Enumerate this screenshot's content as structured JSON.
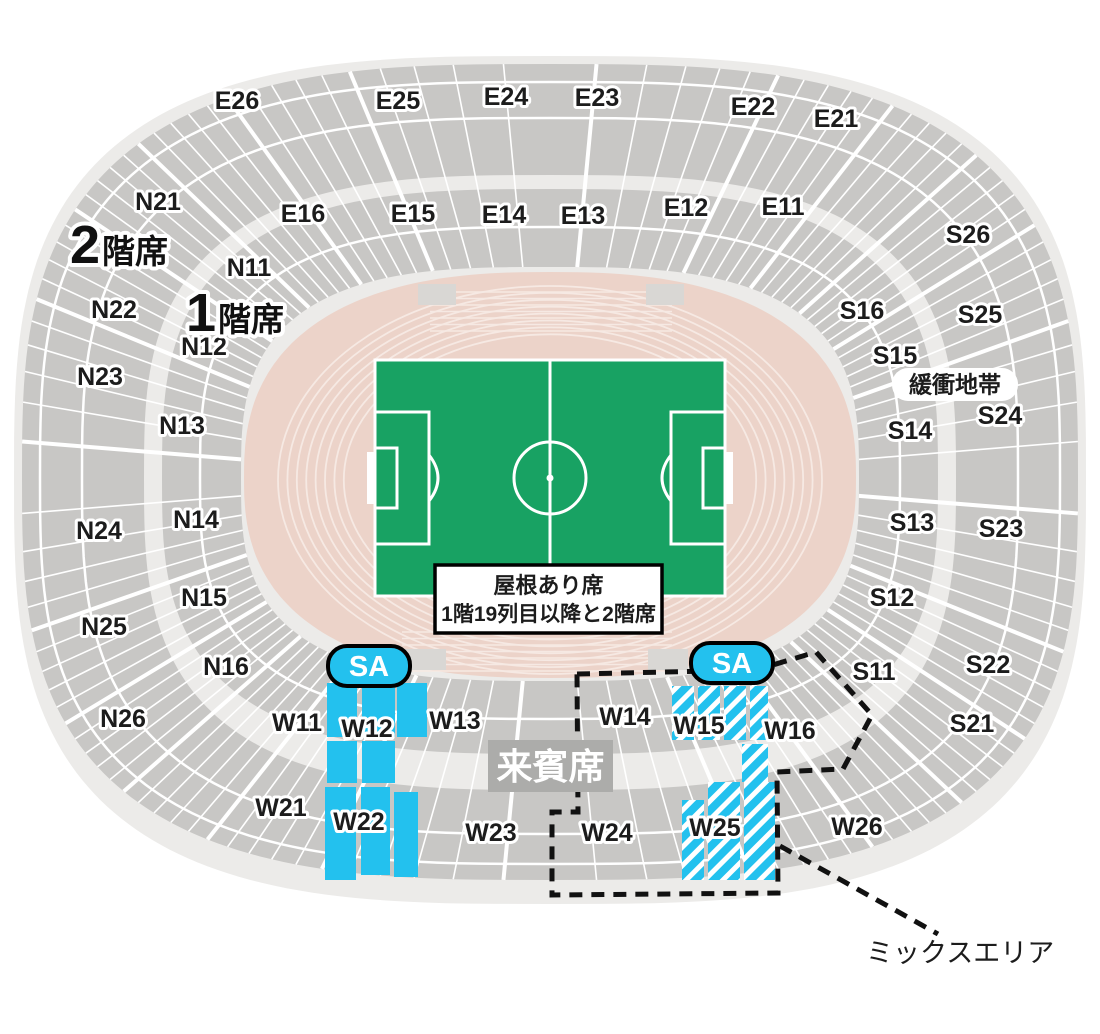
{
  "tier_labels": {
    "tier2": {
      "num": "2",
      "suffix": "階席",
      "x": 70,
      "y": 263
    },
    "tier1": {
      "num": "1",
      "suffix": "階席",
      "x": 186,
      "y": 331
    }
  },
  "info_box": {
    "line1": "屋根あり席",
    "line2": "1階19列目以降と2階席",
    "x": 435,
    "y": 565,
    "w": 227,
    "h": 68
  },
  "badges": {
    "sa_label": "SA",
    "sa_positions": [
      {
        "x": 369,
        "y": 666
      },
      {
        "x": 732,
        "y": 663
      }
    ],
    "vip": {
      "label": "来賓席",
      "x": 488,
      "y": 740,
      "w": 125,
      "h": 52
    },
    "buffer": {
      "label": "緩衝地帯",
      "x": 892,
      "y": 368,
      "w": 126,
      "h": 33
    }
  },
  "mix_area": {
    "label": "ミックスエリア",
    "label_x": 866,
    "label_y": 962,
    "outline_points": "577,674 756,670 816,652 872,715 843,769 777,772 778,893 552,895 552,812 578,812",
    "leader": {
      "x1": 780,
      "y1": 846,
      "x2": 938,
      "y2": 934
    }
  },
  "section_labels": [
    {
      "t": "E26",
      "x": 237,
      "y": 100
    },
    {
      "t": "E25",
      "x": 398,
      "y": 100
    },
    {
      "t": "E24",
      "x": 506,
      "y": 96
    },
    {
      "t": "E23",
      "x": 597,
      "y": 97
    },
    {
      "t": "E22",
      "x": 753,
      "y": 106
    },
    {
      "t": "E21",
      "x": 836,
      "y": 118
    },
    {
      "t": "E16",
      "x": 303,
      "y": 213
    },
    {
      "t": "E15",
      "x": 413,
      "y": 213
    },
    {
      "t": "E14",
      "x": 504,
      "y": 214
    },
    {
      "t": "E13",
      "x": 583,
      "y": 215
    },
    {
      "t": "E12",
      "x": 686,
      "y": 207
    },
    {
      "t": "E11",
      "x": 783,
      "y": 206
    },
    {
      "t": "N21",
      "x": 158,
      "y": 201
    },
    {
      "t": "N22",
      "x": 114,
      "y": 309
    },
    {
      "t": "N23",
      "x": 100,
      "y": 376
    },
    {
      "t": "N24",
      "x": 99,
      "y": 530
    },
    {
      "t": "N25",
      "x": 104,
      "y": 626
    },
    {
      "t": "N26",
      "x": 123,
      "y": 718
    },
    {
      "t": "N11",
      "x": 249,
      "y": 267
    },
    {
      "t": "N12",
      "x": 204,
      "y": 346
    },
    {
      "t": "N13",
      "x": 182,
      "y": 425
    },
    {
      "t": "N14",
      "x": 196,
      "y": 519
    },
    {
      "t": "N15",
      "x": 204,
      "y": 597
    },
    {
      "t": "N16",
      "x": 226,
      "y": 666
    },
    {
      "t": "S26",
      "x": 968,
      "y": 234
    },
    {
      "t": "S25",
      "x": 980,
      "y": 314
    },
    {
      "t": "S24",
      "x": 1000,
      "y": 415
    },
    {
      "t": "S23",
      "x": 1001,
      "y": 528
    },
    {
      "t": "S22",
      "x": 988,
      "y": 664
    },
    {
      "t": "S21",
      "x": 972,
      "y": 723
    },
    {
      "t": "S16",
      "x": 862,
      "y": 310
    },
    {
      "t": "S15",
      "x": 895,
      "y": 355
    },
    {
      "t": "S14",
      "x": 910,
      "y": 430
    },
    {
      "t": "S13",
      "x": 912,
      "y": 522
    },
    {
      "t": "S12",
      "x": 892,
      "y": 597
    },
    {
      "t": "S11",
      "x": 874,
      "y": 671
    },
    {
      "t": "W11",
      "x": 297,
      "y": 722
    },
    {
      "t": "W12",
      "x": 367,
      "y": 728
    },
    {
      "t": "W13",
      "x": 455,
      "y": 720
    },
    {
      "t": "W14",
      "x": 625,
      "y": 716
    },
    {
      "t": "W15",
      "x": 699,
      "y": 725
    },
    {
      "t": "W16",
      "x": 790,
      "y": 730
    },
    {
      "t": "W21",
      "x": 281,
      "y": 807
    },
    {
      "t": "W22",
      "x": 359,
      "y": 821
    },
    {
      "t": "W23",
      "x": 491,
      "y": 832
    },
    {
      "t": "W24",
      "x": 607,
      "y": 832
    },
    {
      "t": "W25",
      "x": 715,
      "y": 827
    },
    {
      "t": "W26",
      "x": 857,
      "y": 826
    }
  ],
  "highlight_zones": {
    "solid": [
      [
        327,
        683,
        30,
        54
      ],
      [
        362,
        683,
        33,
        54
      ],
      [
        397,
        683,
        30,
        54
      ],
      [
        327,
        741,
        30,
        42
      ],
      [
        362,
        741,
        33,
        42
      ],
      [
        325,
        787,
        31,
        93
      ],
      [
        361,
        787,
        29,
        88
      ],
      [
        394,
        792,
        24,
        85
      ]
    ],
    "hatched": [
      [
        672,
        686,
        22,
        54
      ],
      [
        698,
        686,
        22,
        54
      ],
      [
        724,
        686,
        22,
        54
      ],
      [
        750,
        686,
        18,
        54
      ],
      [
        742,
        744,
        26,
        38
      ],
      [
        708,
        782,
        32,
        98
      ],
      [
        744,
        782,
        31,
        98
      ],
      [
        682,
        800,
        22,
        80
      ]
    ]
  },
  "colors": {
    "base": "#ecebe9",
    "block": "#c8c7c5",
    "lane_line": "#f6e9e3",
    "track": "#ecd3c9",
    "track_block": "#d9d7d4",
    "pitch": "#18a263",
    "cyan": "#23c1ee",
    "badge_gray": "#acacaa",
    "ink": "#1c1c1c",
    "dash": "#111111"
  }
}
